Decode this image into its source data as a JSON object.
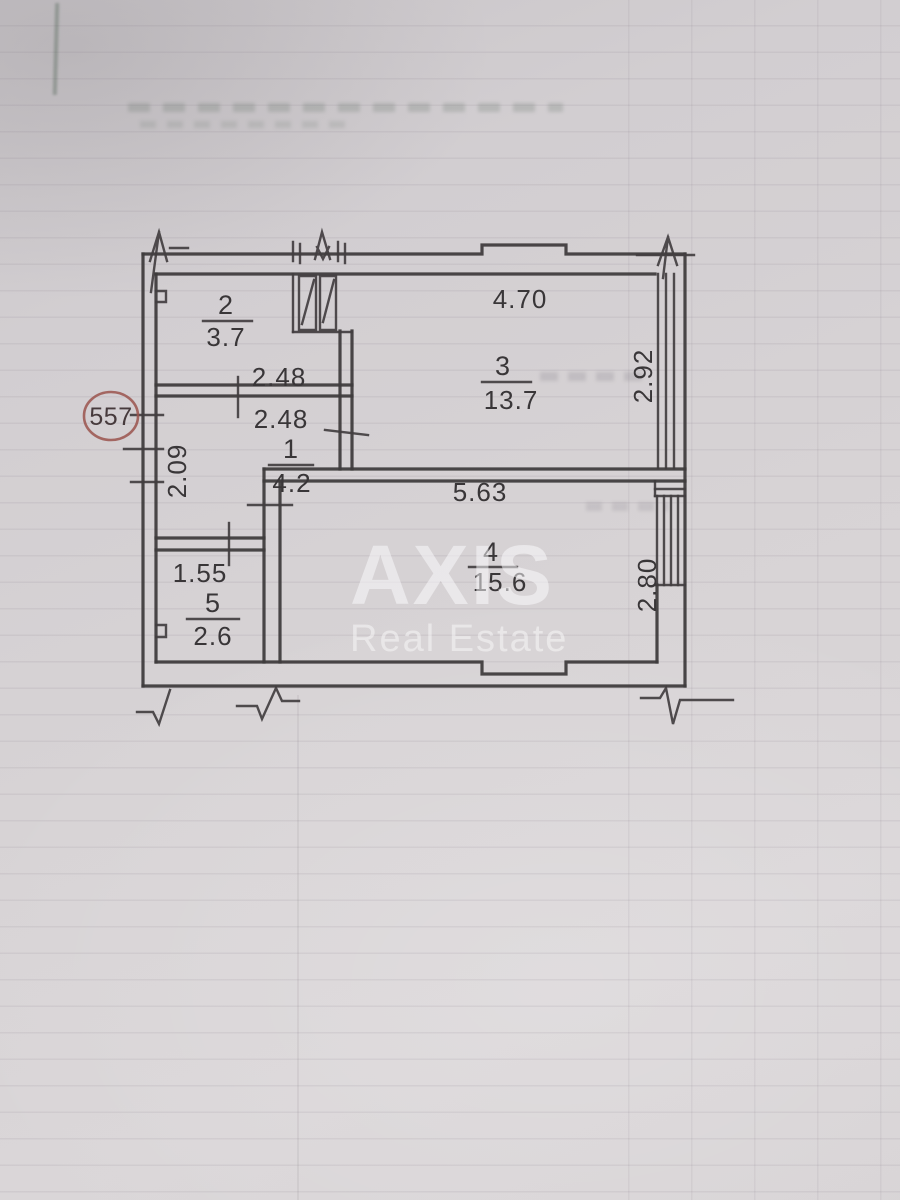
{
  "plan": {
    "unit_badge": "557",
    "rooms": [
      {
        "number": "1",
        "area": "4.2"
      },
      {
        "number": "2",
        "area": "3.7"
      },
      {
        "number": "3",
        "area": "13.7"
      },
      {
        "number": "4",
        "area": "15.6"
      },
      {
        "number": "5",
        "area": "2.6"
      }
    ],
    "dimensions": {
      "room2_width": "2.48",
      "hall_width": "2.48",
      "hall_depth": "2.09",
      "room3_width": "4.70",
      "room3_depth": "2.92",
      "room4_width": "5.63",
      "room4_depth": "2.80",
      "room5_width": "1.55"
    }
  },
  "watermark": {
    "brand": "AXIS",
    "tagline": "Real Estate"
  },
  "colors": {
    "paper": "#d6d2d4",
    "ink": "#3f3b3d",
    "stamp_red": "#9a544e",
    "watermark_white": "#fcfcfd"
  }
}
